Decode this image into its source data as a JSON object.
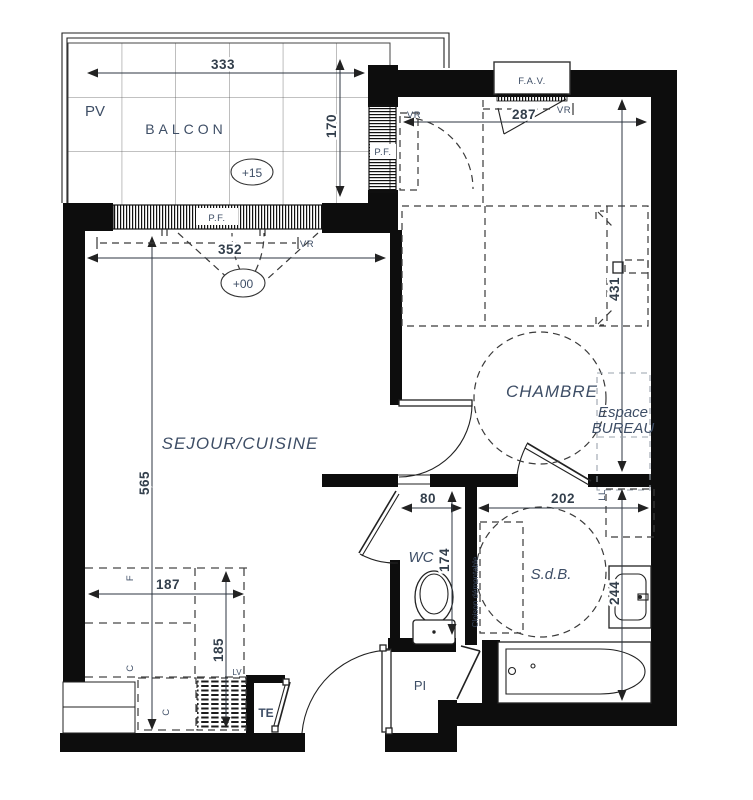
{
  "plan": {
    "rooms": {
      "balcon": "BALCON",
      "sejour_cuisine": "SEJOUR/CUISINE",
      "chambre": "CHAMBRE",
      "espace_bureau_line1": "Espace",
      "espace_bureau_line2": "BUREAU",
      "wc": "WC",
      "sdb": "S.d.B.",
      "pi": "PI"
    },
    "levels": {
      "balcon": "+15",
      "sejour": "+00"
    },
    "annotations": {
      "pv": "PV",
      "fav": "F.A.V.",
      "pf": "P.F.",
      "vr": "VR",
      "ll": "LL",
      "te": "TE",
      "cloison": "Cloison démontable",
      "fridge": "F",
      "hob": "C",
      "kitchen_unit": "C",
      "dishwasher": "LV"
    },
    "dimensions_cm": {
      "balcon_width": "333",
      "balcon_depth": "170",
      "sejour_width": "352",
      "sejour_depth": "565",
      "chambre_width": "287",
      "chambre_depth": "431",
      "kitchen_width": "187",
      "kitchen_depth": "185",
      "wc_width": "80",
      "wc_depth": "174",
      "sdb_width": "202",
      "sdb_depth": "244"
    }
  }
}
